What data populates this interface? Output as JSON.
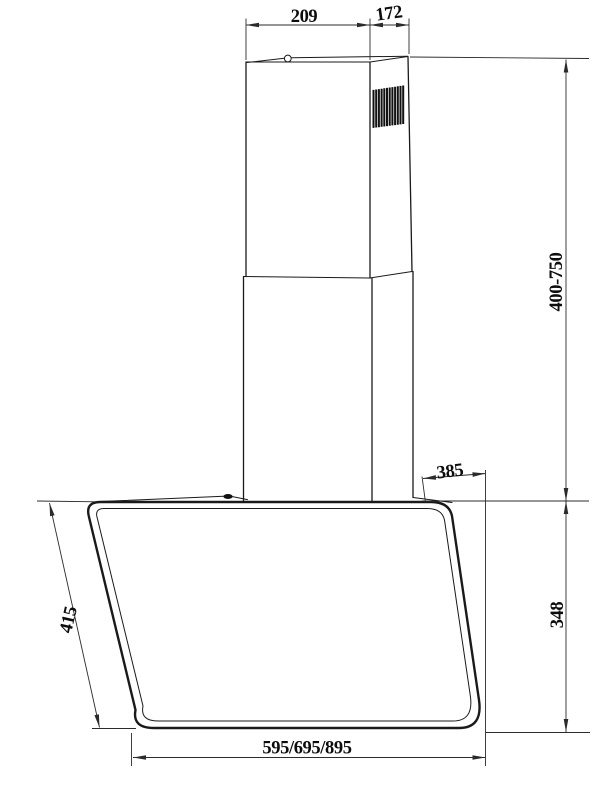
{
  "drawing": {
    "colors": {
      "line": "#1a1a1a",
      "background": "#ffffff"
    },
    "labels": {
      "chimney_top_width": "209",
      "chimney_top_depth": "172",
      "chimney_height_range": "400-750",
      "hood_top_depth": "385",
      "hood_right_height": "348",
      "panel_slant_length": "415",
      "hood_width_variants": "595/695/895"
    }
  }
}
